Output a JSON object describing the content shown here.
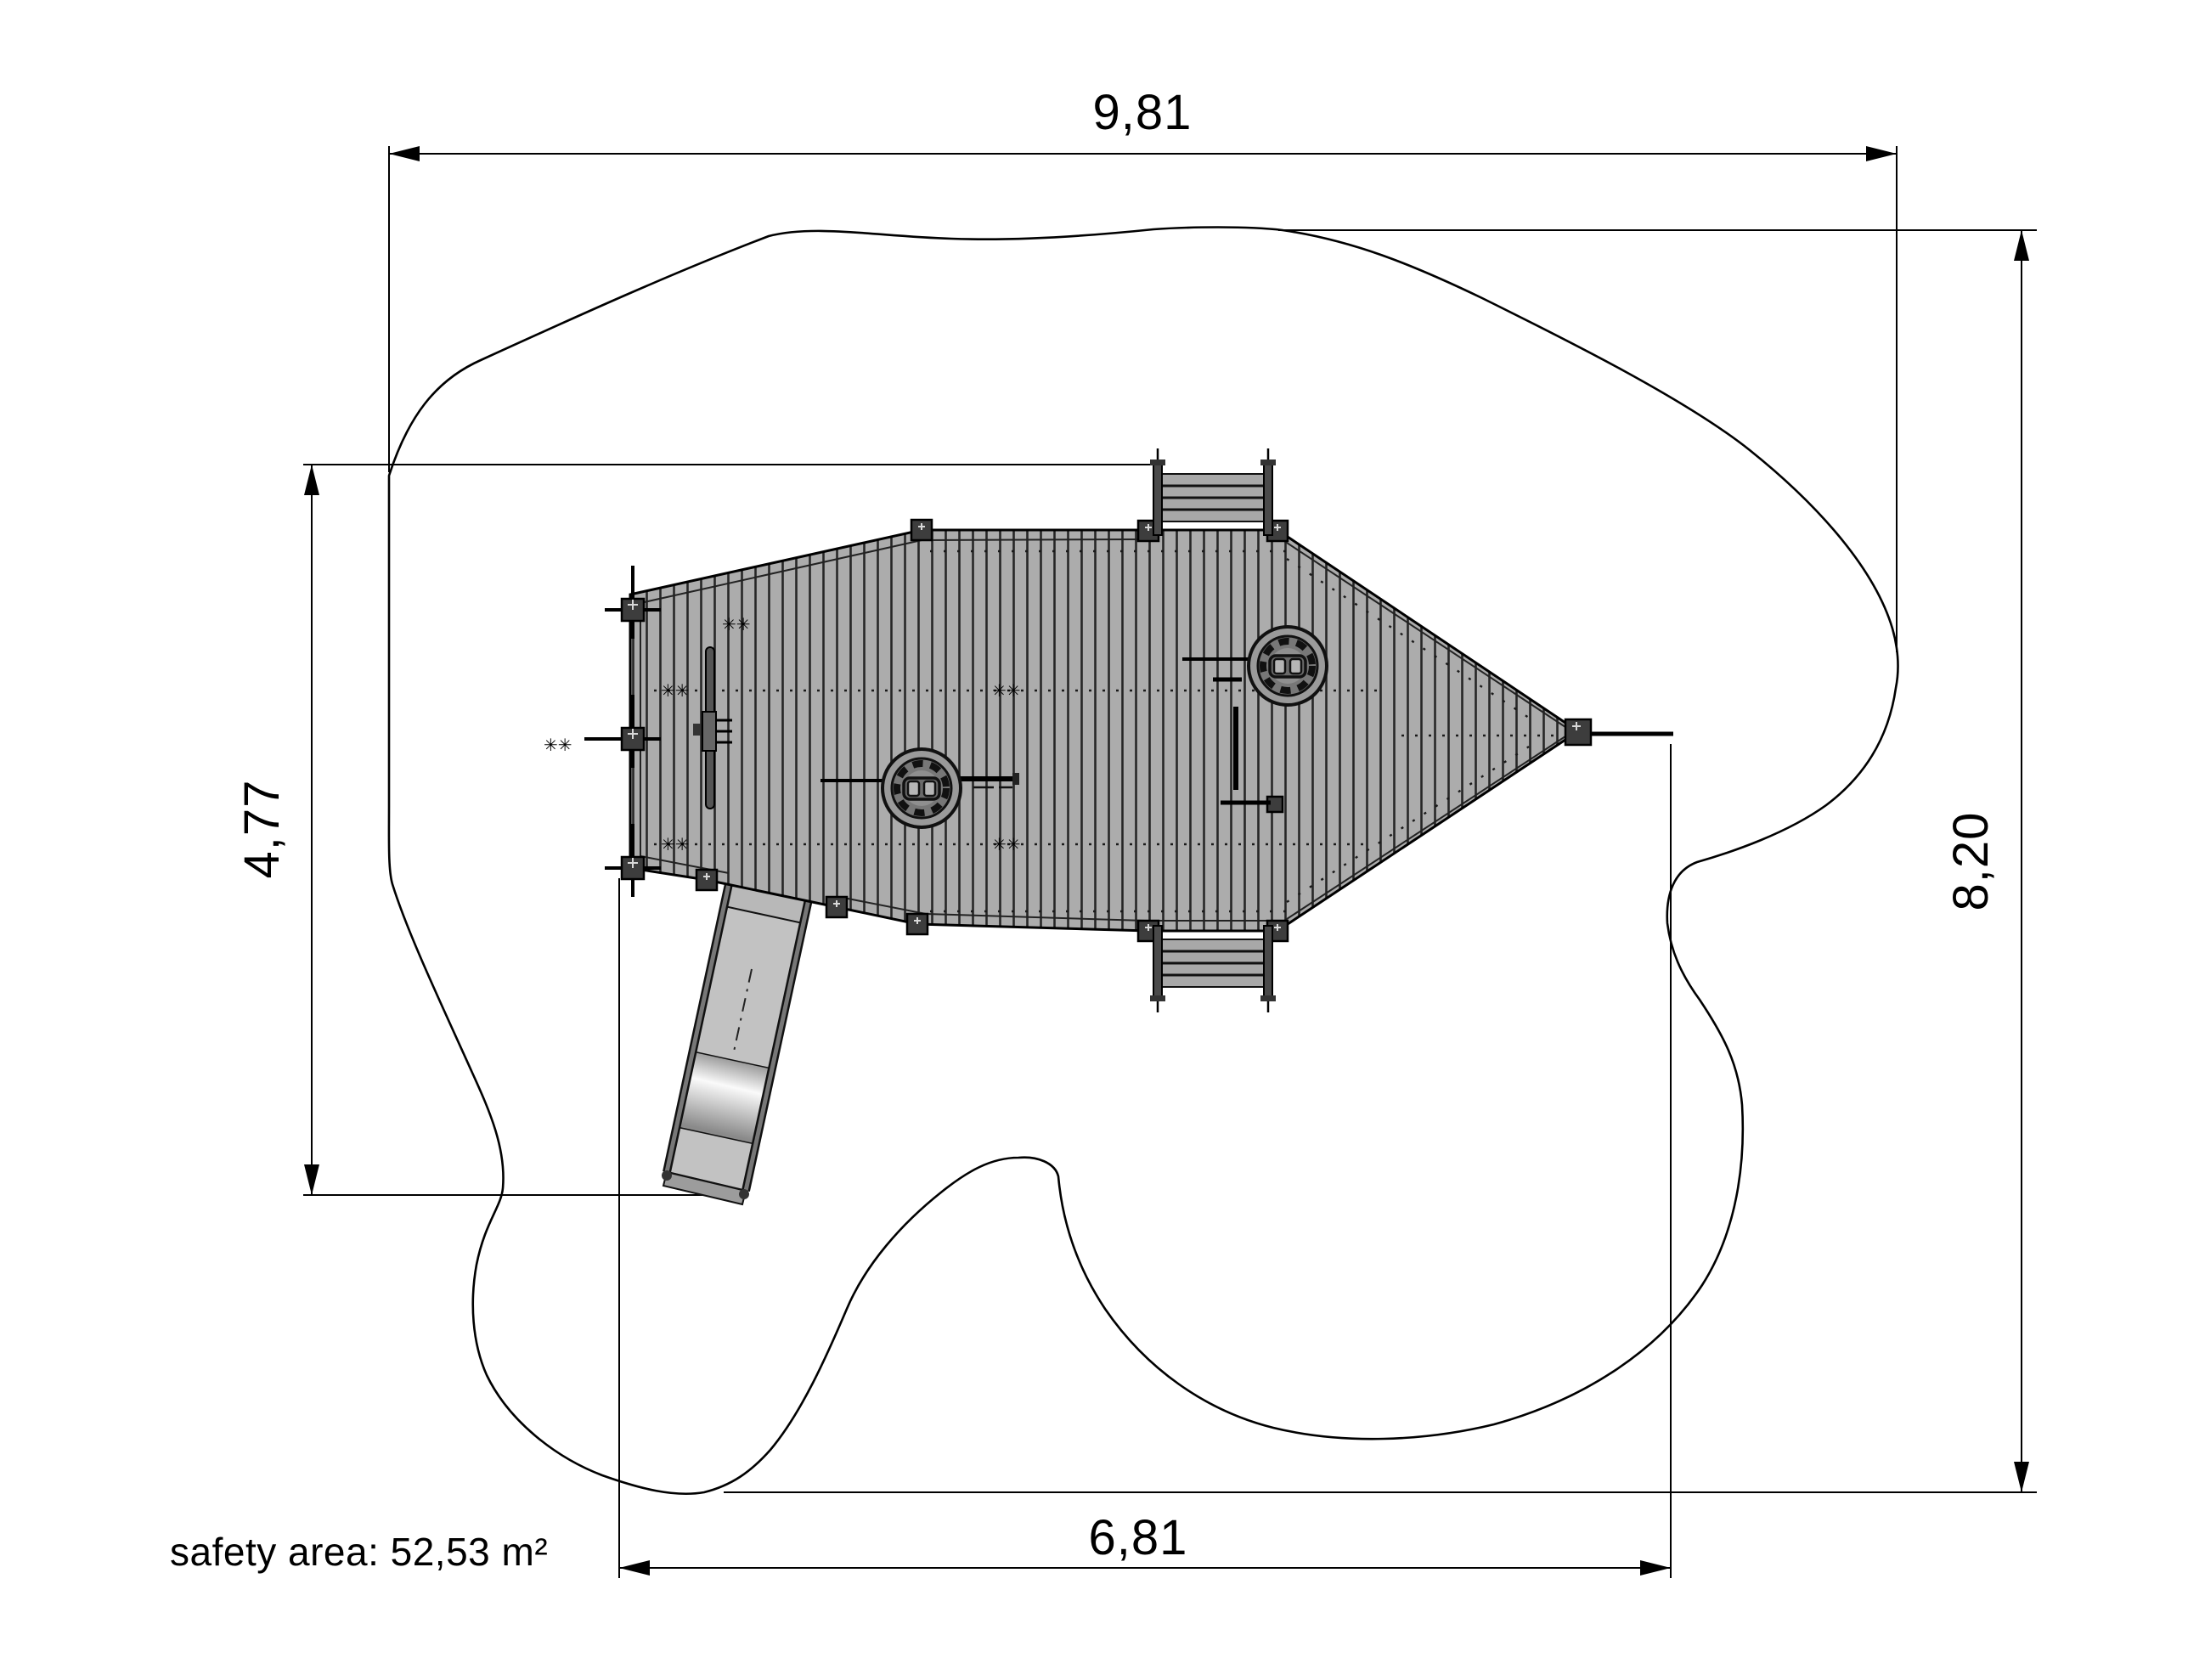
{
  "drawing": {
    "title": "playground equipment safety-area plan view",
    "dimensions": {
      "overall_width": {
        "label": "9,81",
        "unit": "m",
        "orientation": "horizontal-top"
      },
      "overall_height": {
        "label": "8,20",
        "unit": "m",
        "orientation": "vertical-right"
      },
      "structure_height": {
        "label": "4,77",
        "unit": "m",
        "orientation": "vertical-left"
      },
      "structure_width": {
        "label": "6,81",
        "unit": "m",
        "orientation": "horizontal-bottom"
      }
    },
    "safety_area": {
      "label": "safety area: 52,53 m²",
      "value": "52,53",
      "unit": "m²"
    },
    "deck_marks": {
      "pair": "✳✳"
    },
    "colors": {
      "background": "#ffffff",
      "line": "#000000",
      "deck": "#acacac",
      "plank_line": "#262626",
      "equipment": "#9a9a9a",
      "slide": "#c2c2c2",
      "slide_platform": "#b8b8b8",
      "post": "#3d3d3d",
      "ladder": "#a8a8a8"
    }
  }
}
